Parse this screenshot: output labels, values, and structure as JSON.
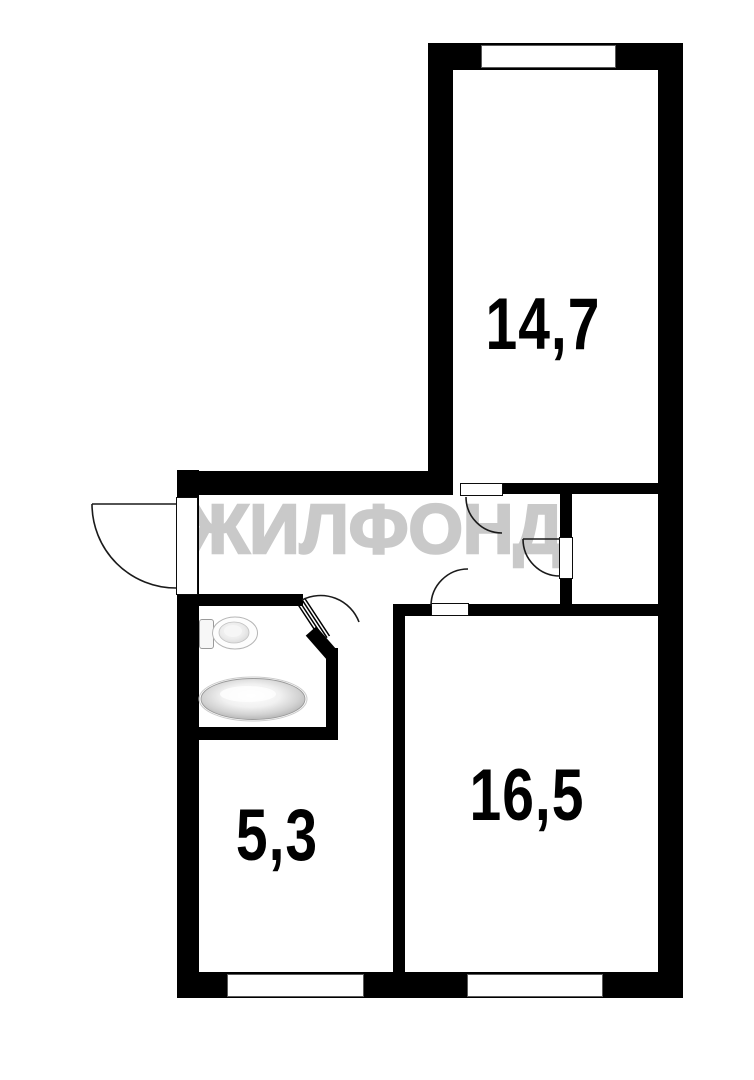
{
  "floor_plan": {
    "watermark_text": "ЖИЛФОНД",
    "rooms": [
      {
        "id": "room-top",
        "area_label": "14,7"
      },
      {
        "id": "room-bottom-right",
        "area_label": "16,5"
      },
      {
        "id": "room-bottom-left",
        "area_label": "5,3"
      }
    ],
    "fixtures": [
      {
        "id": "toilet-icon"
      },
      {
        "id": "sink-icon"
      }
    ],
    "doors": [
      {
        "id": "entry-door"
      },
      {
        "id": "room-top-door"
      },
      {
        "id": "closet-door"
      },
      {
        "id": "room-bottom-right-door"
      },
      {
        "id": "bathroom-door"
      }
    ],
    "windows": [
      {
        "id": "window-room-top"
      },
      {
        "id": "window-room-bottom-left"
      },
      {
        "id": "window-room-bottom-right"
      }
    ],
    "colors": {
      "wall": "#000000",
      "floor": "#ffffff",
      "watermark": "#c9c9c9",
      "door_line": "#1a1a1a"
    }
  }
}
